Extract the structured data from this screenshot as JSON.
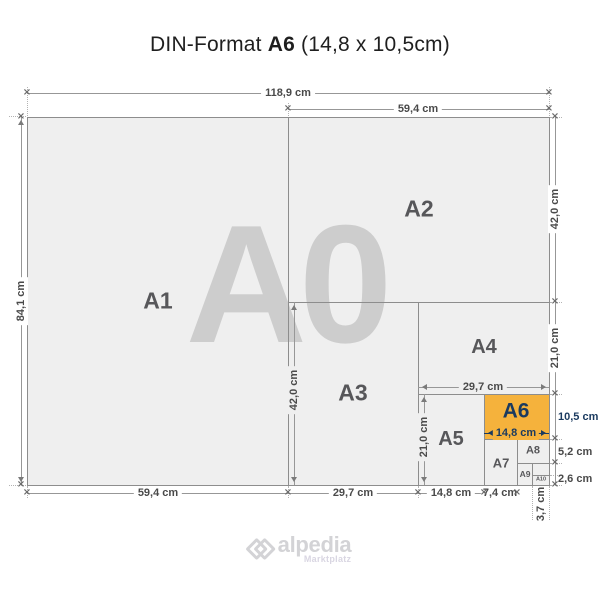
{
  "title": {
    "prefix": "DIN-Format ",
    "format": "A6",
    "suffix": " (14,8 x 10,5cm)"
  },
  "watermark": "A0",
  "formats": {
    "a1": "A1",
    "a2": "A2",
    "a3": "A3",
    "a4": "A4",
    "a5": "A5",
    "a6": "A6",
    "a7": "A7",
    "a8": "A8",
    "a9": "A9",
    "a10": "A10"
  },
  "dims": {
    "width_a0": "118,9 cm",
    "width_a1_top": "59,4 cm",
    "height_a0": "84,1 cm",
    "height_a2": "42,0 cm",
    "height_a4": "21,0 cm",
    "height_a6": "10,5 cm",
    "height_a8": "5,2 cm",
    "height_a10": "2,6 cm",
    "width_a1_bottom": "59,4 cm",
    "width_a3_bottom": "29,7 cm",
    "width_a5_bottom": "14,8 cm",
    "width_a7": "7,4 cm",
    "width_a10": "3,7 cm",
    "height_a3_inner": "42,0 cm",
    "height_a5_inner": "21,0 cm",
    "width_a4_inner": "29,7 cm",
    "width_a6_inner": "14,8 cm"
  },
  "colors": {
    "highlight": "#F5B23C",
    "highlight_text": "#1A3A5F",
    "paper": "#EFEFEF",
    "border": "#8D8D8D",
    "label_gray": "#57575A",
    "watermark_gray": "#CDCDCD"
  },
  "logo": {
    "brand": "alpedia",
    "tagline": "Marktplatz"
  }
}
